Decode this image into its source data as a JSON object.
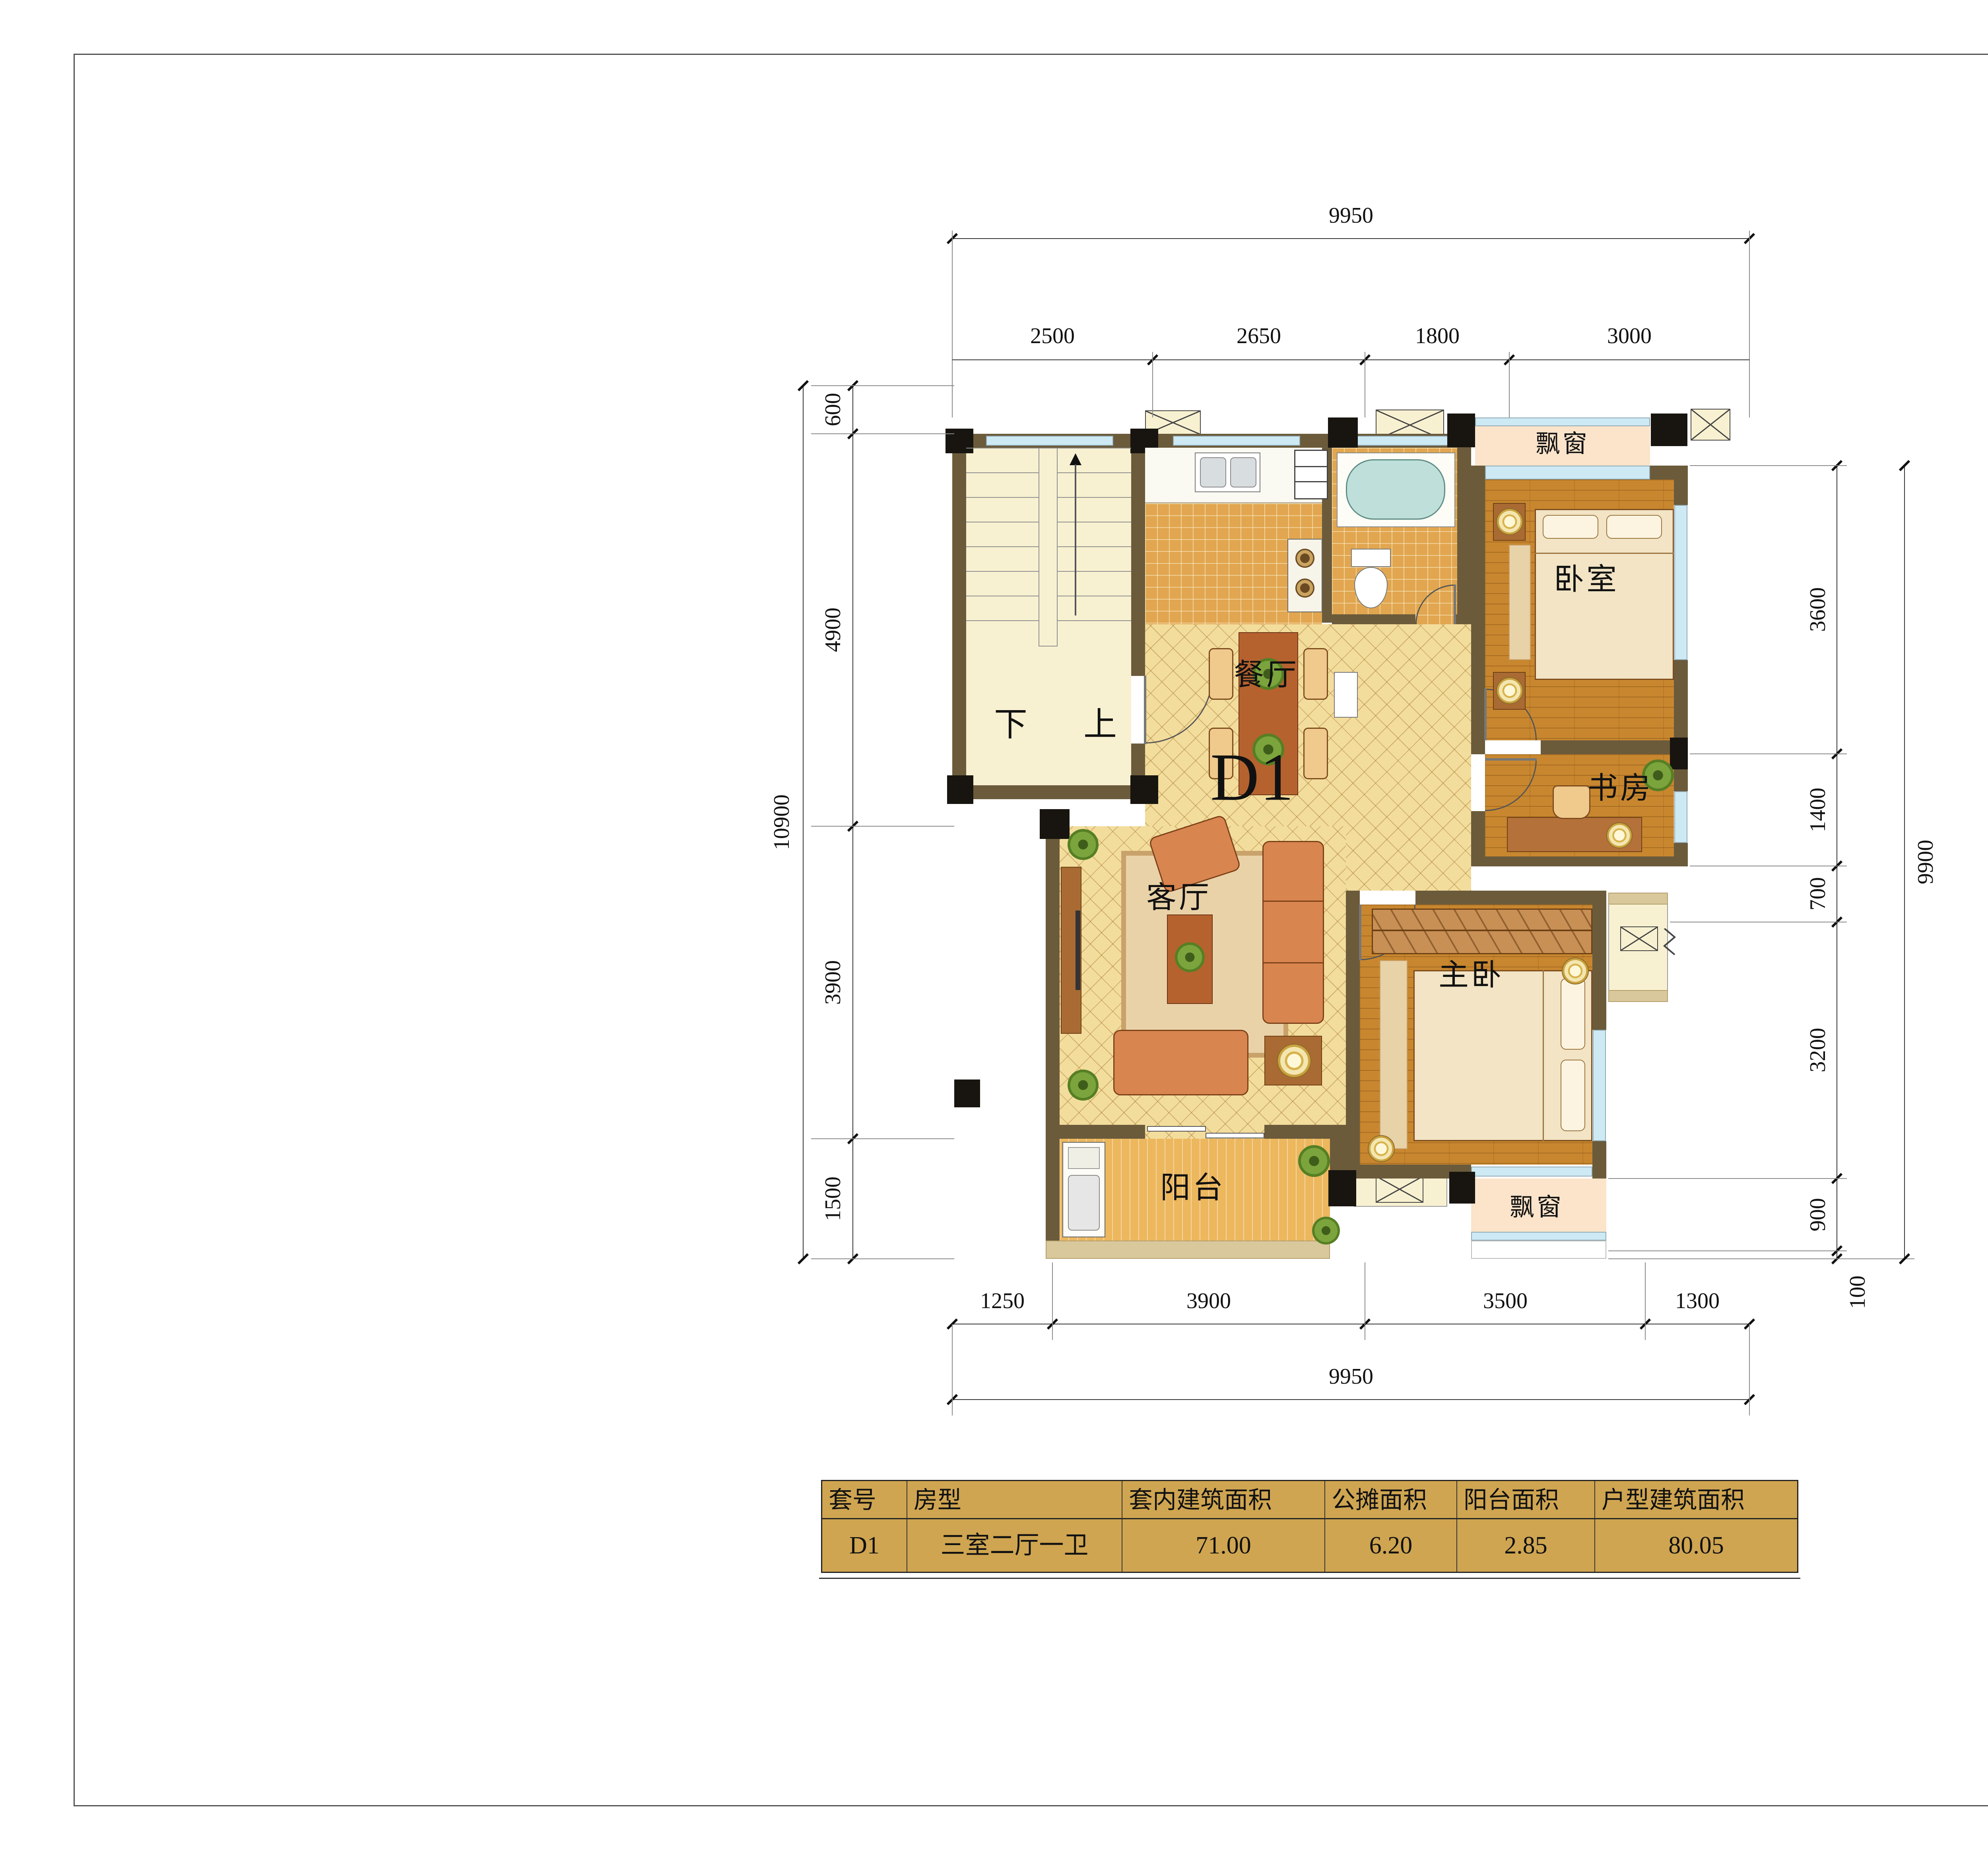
{
  "plan": {
    "unit_label": "D1",
    "stair": {
      "down_label": "下",
      "up_label": "上"
    },
    "rooms": {
      "bay_top": "飘窗",
      "bedroom": "卧室",
      "study": "书房",
      "dining": "餐厅",
      "living": "客厅",
      "master": "主卧",
      "balcony": "阳台",
      "bay_bottom": "飘窗"
    }
  },
  "dimensions": {
    "top": {
      "overall": "9950",
      "segments": [
        "2500",
        "2650",
        "1800",
        "3000"
      ]
    },
    "bottom": {
      "overall": "9950",
      "segments": [
        "1250",
        "3900",
        "3500",
        "1300"
      ]
    },
    "left": {
      "overall": "10900",
      "segments": [
        "600",
        "4900",
        "3900",
        "1500"
      ]
    },
    "right": {
      "overall": "9900",
      "segments": [
        "3600",
        "1400",
        "700",
        "3200",
        "900",
        "100"
      ]
    }
  },
  "table": {
    "headers": [
      "套号",
      "房型",
      "套内建筑面积",
      "公摊面积",
      "阳台面积",
      "户型建筑面积"
    ],
    "rows": [
      [
        "D1",
        "三室二厅一卫",
        "71.00",
        "6.20",
        "2.85",
        "80.05"
      ]
    ]
  },
  "colors": {
    "wall": "#6b5b3b",
    "table_bg": "#cfa551",
    "window_glass": "#cdeaf4",
    "diamond_tile": "#f3dd9d",
    "wood_floor": "#c8872f",
    "bay_window_fill": "#fbe4ca",
    "stairwell": "#f8f1d1"
  }
}
